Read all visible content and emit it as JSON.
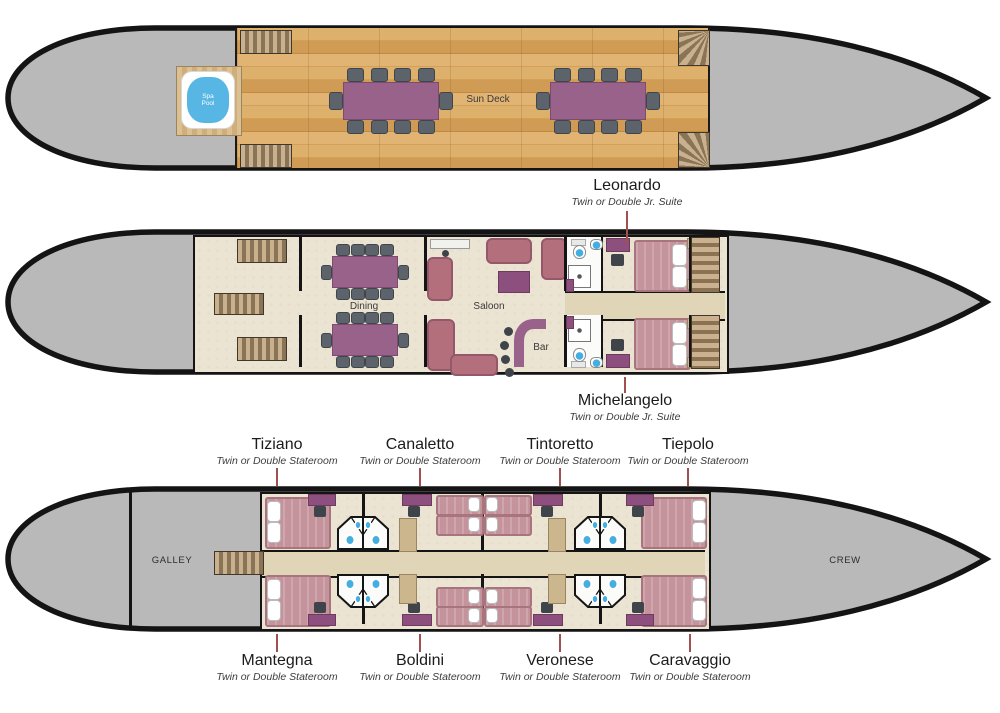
{
  "decks": {
    "sun": {
      "label": "Sun Deck",
      "spa_pool": "Spa Pool"
    },
    "main": {
      "dining": "Dining",
      "saloon": "Saloon",
      "bar": "Bar"
    },
    "lower": {
      "galley": "GALLEY",
      "crew": "CREW"
    }
  },
  "cabins": {
    "jr_suites": [
      {
        "name": "Leonardo",
        "type": "Twin or Double Jr. Suite"
      },
      {
        "name": "Michelangelo",
        "type": "Twin or Double Jr. Suite"
      }
    ],
    "top_row": [
      {
        "name": "Tiziano",
        "type": "Twin or Double Stateroom"
      },
      {
        "name": "Canaletto",
        "type": "Twin or Double Stateroom"
      },
      {
        "name": "Tintoretto",
        "type": "Twin or Double Stateroom"
      },
      {
        "name": "Tiepolo",
        "type": "Twin or Double Stateroom"
      }
    ],
    "bottom_row": [
      {
        "name": "Mantegna",
        "type": "Twin or Double Stateroom"
      },
      {
        "name": "Boldini",
        "type": "Twin or Double Stateroom"
      },
      {
        "name": "Veronese",
        "type": "Twin or Double Stateroom"
      },
      {
        "name": "Caravaggio",
        "type": "Twin or Double Stateroom"
      }
    ]
  },
  "colors": {
    "deck_gray": "#b9b9b9",
    "hull_outline": "#141414",
    "accent_purple": "#99628a",
    "furniture_purple": "#8d4f7d",
    "sofa_mauve": "#b3707c",
    "bed_pink": "#c4939b",
    "floor_cream": "#ece4d2",
    "corridor_tan": "#e0d5b6",
    "pool_blue": "#57b6e4",
    "fixture_blue": "#45aee0",
    "leader_line": "#a15050"
  }
}
